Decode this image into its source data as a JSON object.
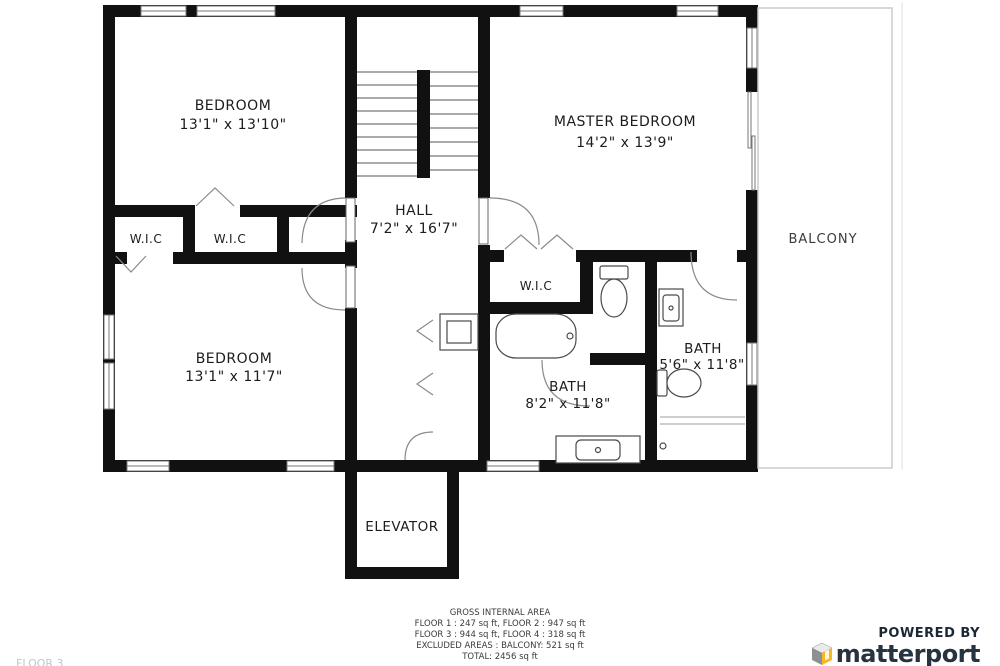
{
  "plan": {
    "rooms": {
      "bedroom1": {
        "name": "BEDROOM",
        "dims": "13'1\" x 13'10\""
      },
      "master": {
        "name": "MASTER BEDROOM",
        "dims": "14'2\" x 13'9\""
      },
      "hall": {
        "name": "HALL",
        "dims": "7'2\" x 16'7\""
      },
      "bedroom2": {
        "name": "BEDROOM",
        "dims": "13'1\" x 11'7\""
      },
      "wic1": {
        "name": "W.I.C"
      },
      "wic2": {
        "name": "W.I.C"
      },
      "wic3": {
        "name": "W.I.C"
      },
      "bath1": {
        "name": "BATH",
        "dims": "8'2\" x 11'8\""
      },
      "bath2": {
        "name": "BATH",
        "dims": "5'6\" x 11'8\""
      },
      "balcony": {
        "name": "BALCONY"
      },
      "elevator": {
        "name": "ELEVATOR"
      }
    }
  },
  "footer": {
    "title": "GROSS INTERNAL AREA",
    "line1": "FLOOR 1 : 247 sq ft, FLOOR 2 : 947 sq ft",
    "line2": "FLOOR 3 : 944 sq ft, FLOOR 4 : 318 sq ft",
    "line3": "EXCLUDED AREAS : BALCONY: 521 sq ft",
    "line4": "TOTAL: 2456 sq ft",
    "floor_label": "FLOOR 3"
  },
  "brand": {
    "powered_by": "POWERED BY",
    "name": "matterport"
  },
  "colors": {
    "wall": "#111111",
    "fixture_line": "#4a4a4a",
    "brand_navy": "#27333f",
    "brand_yellow": "#f6b921",
    "brand_gray": "#8d9093"
  }
}
